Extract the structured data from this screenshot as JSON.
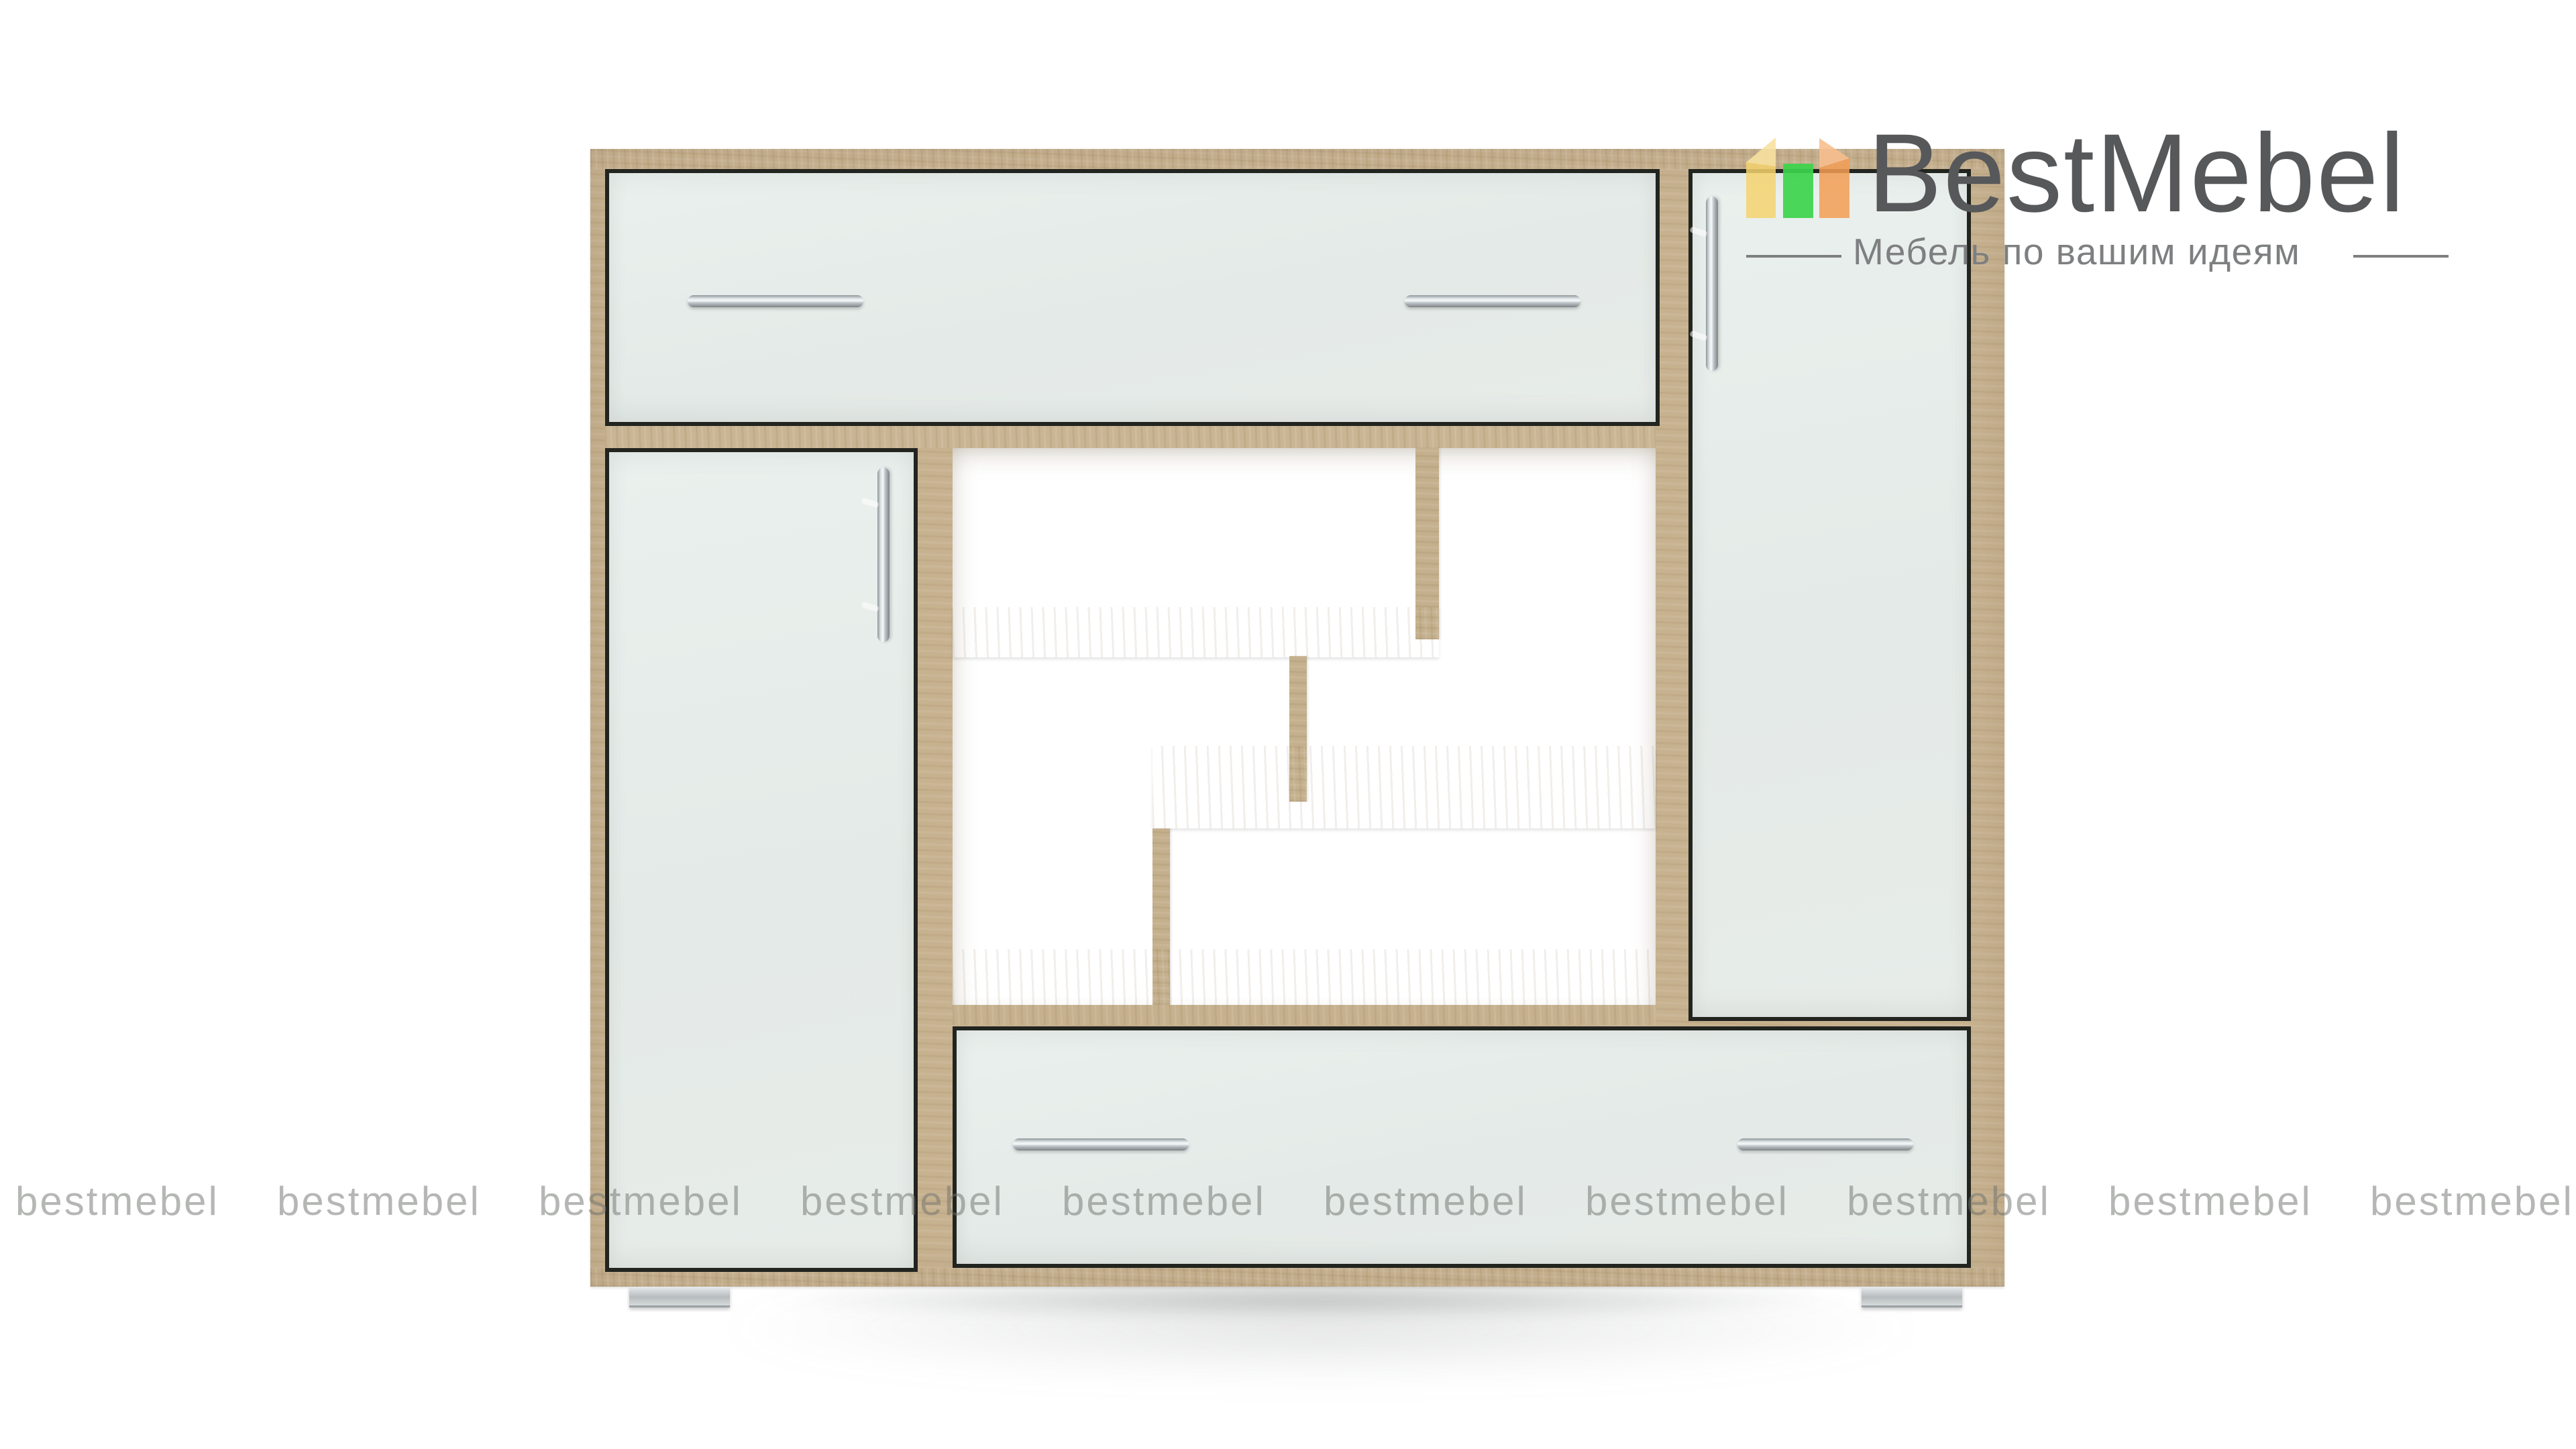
{
  "brand": {
    "name": "BestMebel",
    "tagline": "Мебель по вашим идеям"
  },
  "watermark": {
    "text": "bestmebel",
    "count": 10
  },
  "product": {
    "description": "sideboard with oak frame, white fronts, open zigzag shelves",
    "parts": [
      "top drawer",
      "right door",
      "left door",
      "open shelves",
      "bottom drawer"
    ]
  },
  "colors": {
    "background": "#ffffff",
    "wood": "#c7b290",
    "wood_light": "#d5c7a8",
    "wood_dark": "#b39e7b",
    "seam": "#22241f",
    "front": "#e4eae7",
    "logo_text": "#57585a",
    "tagline_text": "#7d7f80",
    "watermark_text": "#6e726e",
    "accent_yellow": "#f5d26e",
    "accent_green": "#3cd44c",
    "accent_orange": "#f39e55"
  }
}
